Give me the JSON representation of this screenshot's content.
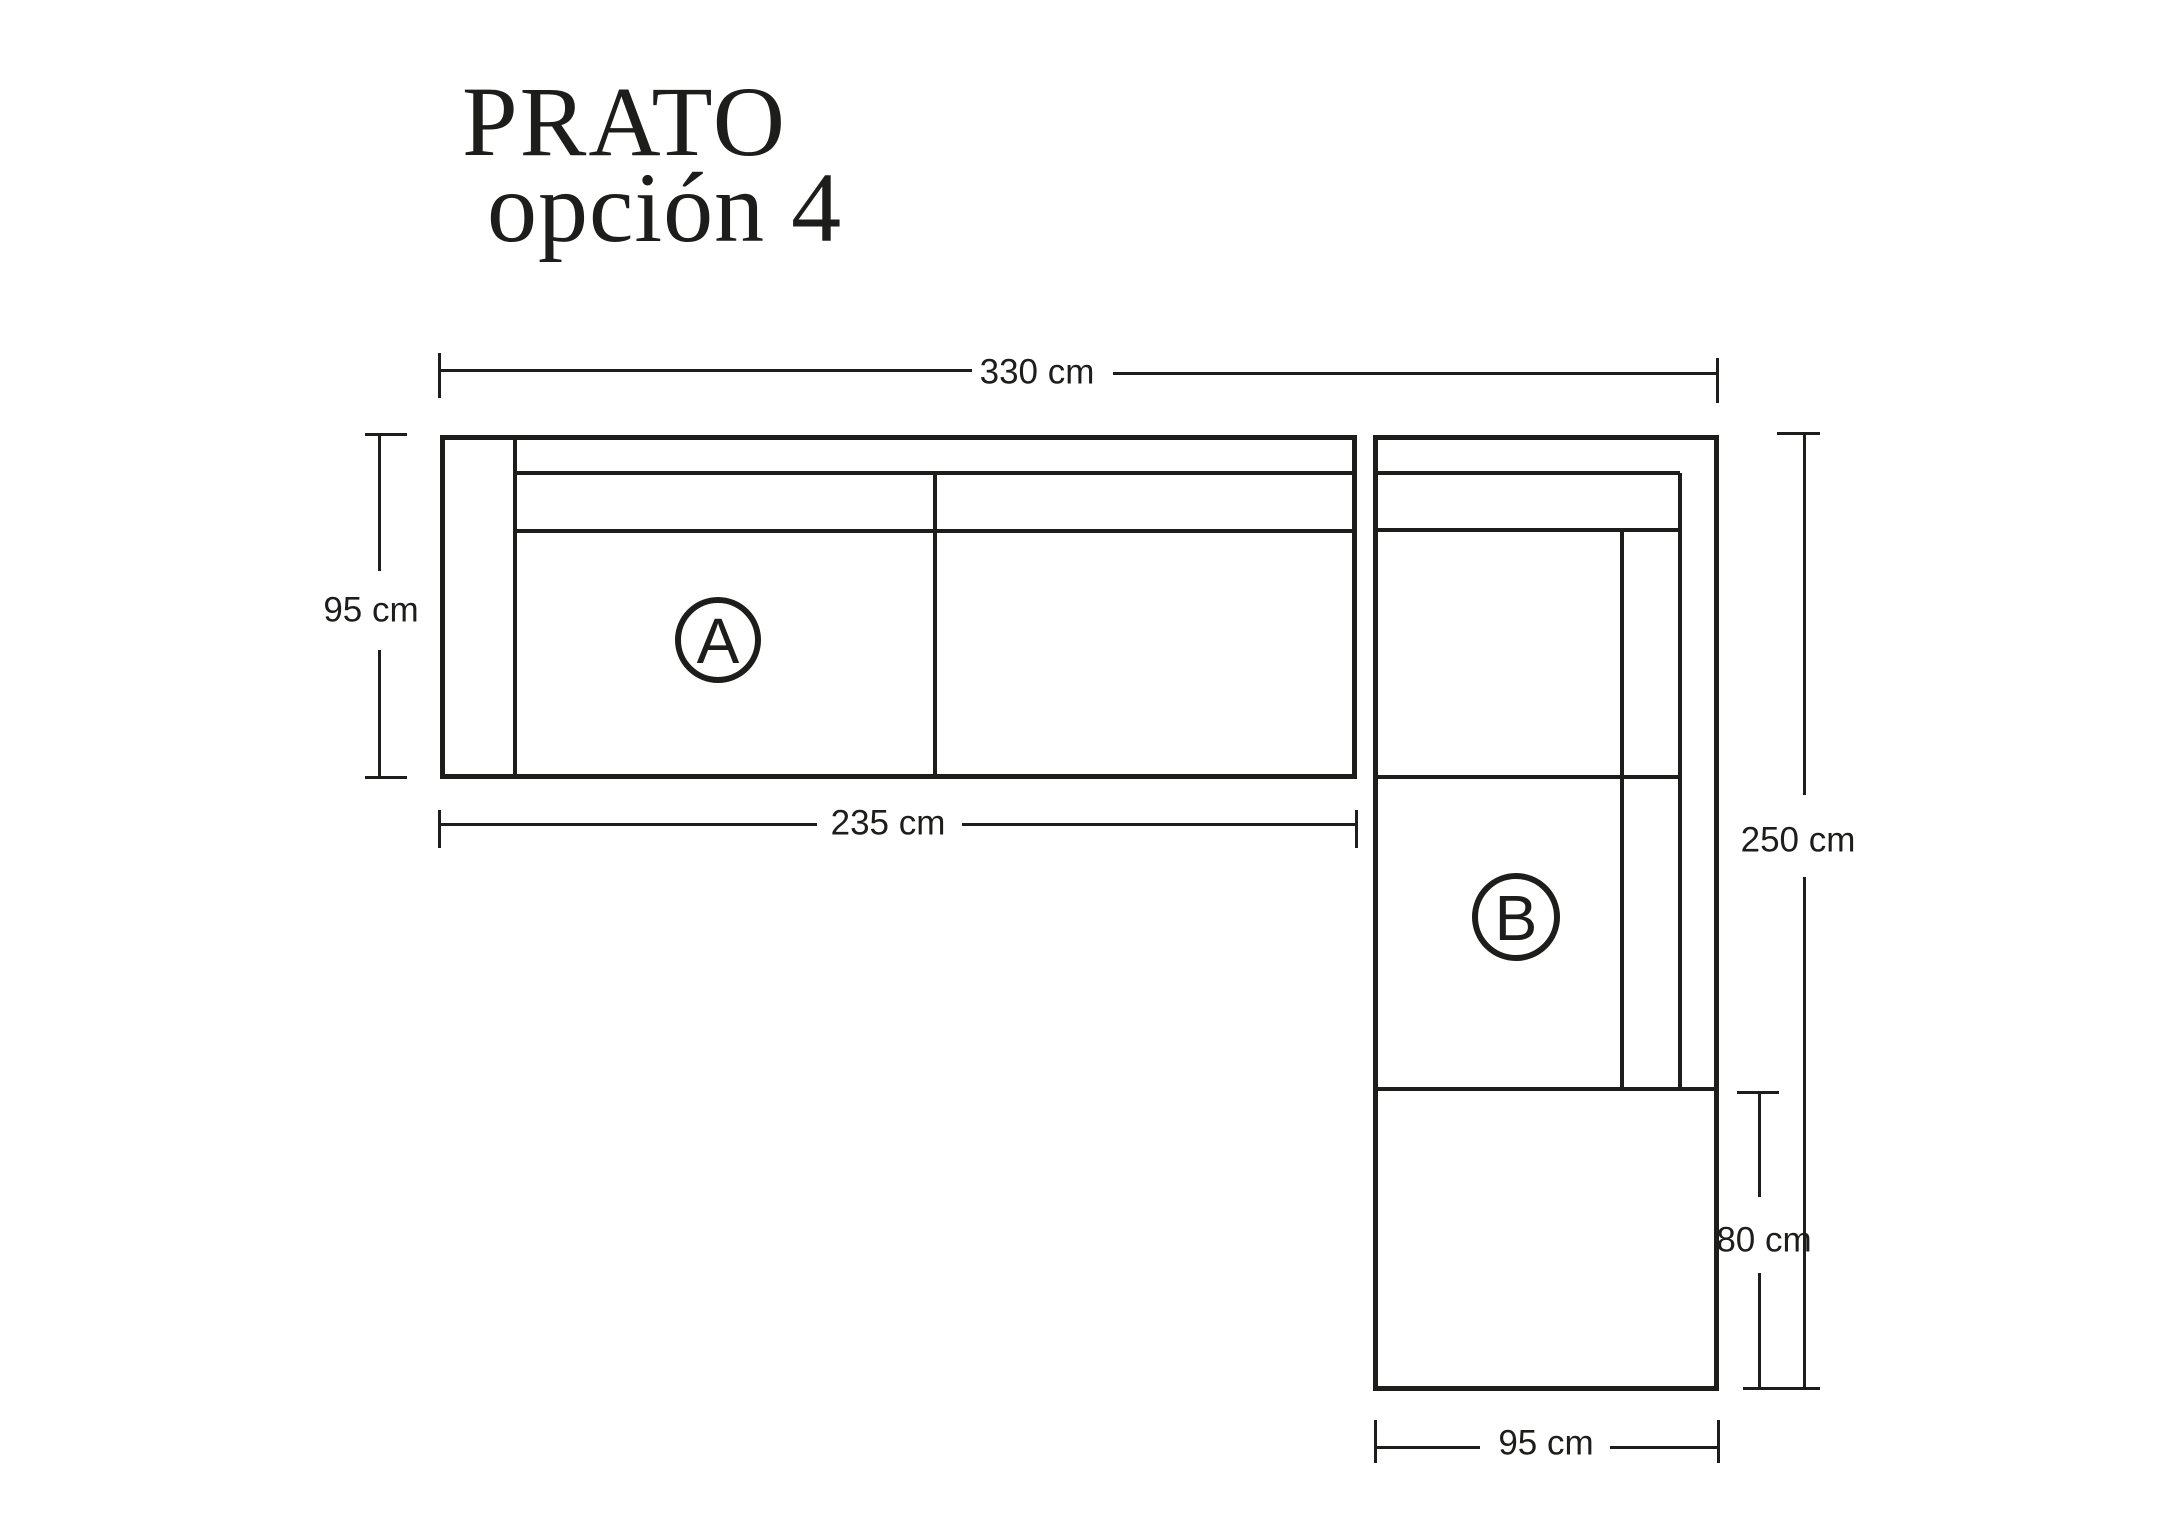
{
  "colors": {
    "ink": "#1d1d1b",
    "background": "#ffffff"
  },
  "title": {
    "line1": "PRATO",
    "line2": "opción 4"
  },
  "sections": {
    "a": {
      "label": "A"
    },
    "b": {
      "label": "B"
    }
  },
  "dimensions": {
    "top_total_width": "330 cm",
    "left_depth_a": "95 cm",
    "bottom_length_a": "235 cm",
    "right_total_length_b": "250 cm",
    "right_ottoman_length": "80 cm",
    "bottom_width_b": "95 cm"
  }
}
